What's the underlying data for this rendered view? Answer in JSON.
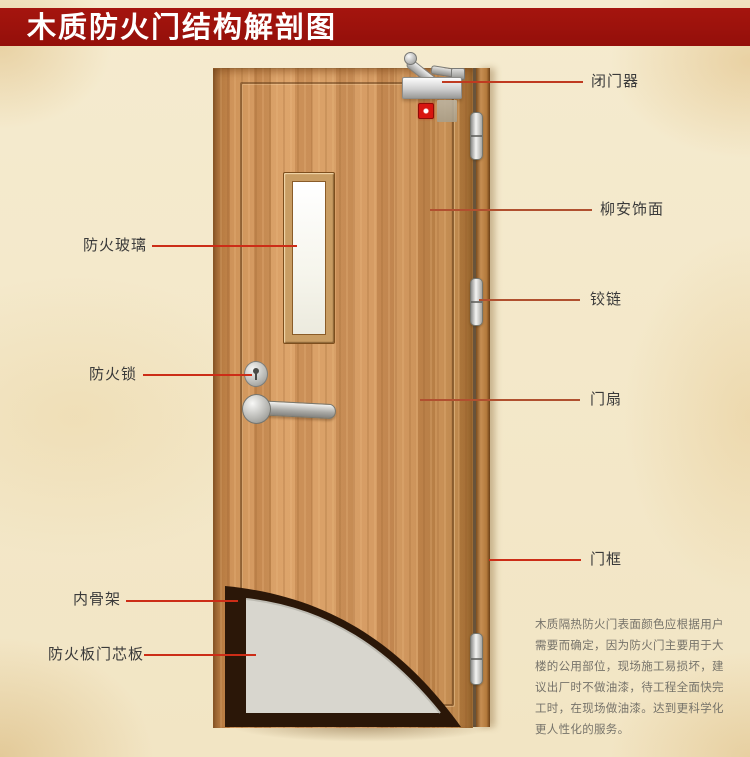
{
  "title": "木质防火门结构解剖图",
  "diagram": {
    "subject": "wooden-fire-door-cutaway",
    "annotations_left": [
      {
        "text": "防火玻璃"
      },
      {
        "text": "防火锁"
      },
      {
        "text": "内骨架"
      },
      {
        "text": "防火板门芯板"
      }
    ],
    "annotations_right": [
      {
        "text": "闭门器"
      },
      {
        "text": "柳安饰面"
      },
      {
        "text": "铰链"
      },
      {
        "text": "门扇"
      },
      {
        "text": "门框"
      }
    ],
    "description_lines": [
      "木质隔热防火门表面颜色应根据用户",
      "需要而确定，因为防火门主要用于大",
      "楼的公用部位，现场施工易损坏，建",
      "议出厂时不做油漆，待工程全面快完",
      "工时，在现场做油漆。达到更科学化",
      "更人性化的服务。"
    ]
  },
  "colors": {
    "banner_background": "#9d110b",
    "banner_text": "#ffffff",
    "page_background": "#f3e7c9",
    "leader_line_red": "#cc2d17",
    "leader_line_brown": "#b0502f",
    "door_wood": "#cf9257",
    "door_frame_wood": "#b57a3c",
    "core_gray": "#d8d6ce",
    "inner_skeleton_dark": "#2b1708",
    "label_text": "#3a3a3a"
  }
}
